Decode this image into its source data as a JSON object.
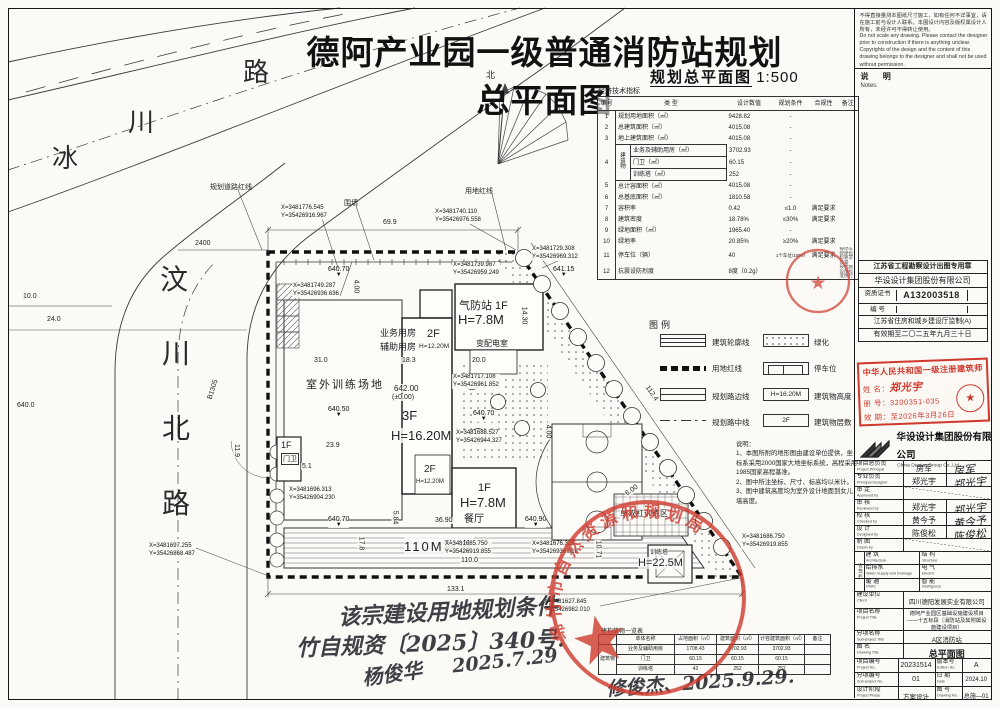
{
  "title": "德阿产业园一级普通消防站规划总平面图",
  "caption": {
    "text": "规划总平面图",
    "scale": "1:500"
  },
  "frame_notes": {
    "disclaimer_zh": "不得直接量测本图纸尺寸施工，如有任何不详事宜，请在施工前与设计人联系。本图设计内容及版权属设计人所有，未经许可不得转让使用。",
    "disclaimer_en": "Do not scale any drawing. Please contact the designer prior to construction if there is anything unclear. Copyrights of the design and the content of this drawing belongs to the designer and shall not be used without permission.",
    "notes_label": "说  明",
    "notes_en": "Notes:"
  },
  "indicators": {
    "title": "经济技术指标",
    "columns": [
      "编号",
      "类  型",
      "设计数值",
      "规划条件",
      "合规性",
      "备注"
    ],
    "group_no": "4",
    "group_label": "建筑物",
    "rows": [
      {
        "no": "1",
        "type": "规划用地面积（㎡）",
        "value": "9428.82",
        "cond": "-",
        "comp": "",
        "note": ""
      },
      {
        "no": "2",
        "type": "总建筑面积（㎡）",
        "value": "4015.08",
        "cond": "-",
        "comp": "",
        "note": ""
      },
      {
        "no": "3",
        "type": "地上建筑面积（㎡）",
        "value": "4015.08",
        "cond": "-",
        "comp": "",
        "note": ""
      },
      {
        "no": "4",
        "type": "业务及辅助用房（㎡）",
        "value": "3702.93",
        "cond": "-",
        "comp": "",
        "note": ""
      },
      {
        "no": "",
        "type": "门卫（㎡）",
        "value": "60.15",
        "cond": "-",
        "comp": "",
        "note": ""
      },
      {
        "no": "",
        "type": "训练塔（㎡）",
        "value": "252",
        "cond": "-",
        "comp": "",
        "note": ""
      },
      {
        "no": "5",
        "type": "总计容面积（㎡）",
        "value": "4015.08",
        "cond": "-",
        "comp": "",
        "note": ""
      },
      {
        "no": "6",
        "type": "总基底面积（㎡）",
        "value": "1810.58",
        "cond": "-",
        "comp": "",
        "note": ""
      },
      {
        "no": "7",
        "type": "容积率",
        "value": "0.42",
        "cond": "≤1.0",
        "comp": "满足要求",
        "note": ""
      },
      {
        "no": "8",
        "type": "建筑密度",
        "value": "18.78%",
        "cond": "≤30%",
        "comp": "满足要求",
        "note": ""
      },
      {
        "no": "9",
        "type": "绿地面积（㎡）",
        "value": "1965.40",
        "cond": "-",
        "comp": "",
        "note": ""
      },
      {
        "no": "10",
        "type": "绿地率",
        "value": "20.85%",
        "cond": "≥20%",
        "comp": "满足要求",
        "note": ""
      },
      {
        "no": "11",
        "type": "停车位（辆）",
        "value": "40",
        "cond": "1个车位/100㎡",
        "comp": "满足要求",
        "note": "按停车配建指标要求设置"
      },
      {
        "no": "12",
        "type": "抗震设防烈度",
        "value": "8度（0.2g）",
        "cond": "",
        "comp": "",
        "note": "按抗震设防标准执行"
      }
    ]
  },
  "legend": {
    "title": "图例",
    "left": [
      {
        "label": "建筑轮廓线"
      },
      {
        "label": "用地红线"
      },
      {
        "label": "规划路边线"
      },
      {
        "label": "规划路中线"
      }
    ],
    "right": [
      {
        "label": "绿化",
        "swatch_text": ""
      },
      {
        "label": "停车位",
        "swatch_text": ""
      },
      {
        "label": "建筑物高度",
        "swatch_text": "H=16.20M"
      },
      {
        "label": "建筑物层数",
        "swatch_text": "2F"
      }
    ]
  },
  "plan_notes": {
    "title": "说明：",
    "lines": [
      "1、本图所附的地形图由建设单位提供，坐标系采用2000国家大地坐标系统，高程采用1985国家高程基准。",
      "2、图中所注坐标、尺寸、标高均以米计。",
      "3、图中建筑高度均为室外设计地面到女儿墙高度。"
    ]
  },
  "roads": {
    "bingchuan": [
      "冰",
      "川",
      "路"
    ],
    "wenchuan": [
      "汶",
      "川",
      "北",
      "路"
    ],
    "north": "北"
  },
  "plan": {
    "leader_labels": {
      "road_red_line": "规划道路红线",
      "fence": "围墙",
      "site_red_line": "用地红线"
    },
    "buildings": {
      "outdoor_field": "室外训练场地",
      "biz_room_1": "业务用房",
      "biz_room_2": "辅助用房",
      "f2a": "2F",
      "f2a_h": "H=12.20M",
      "gas_station": "气防站 1F",
      "gas_station_h": "H=7.8M",
      "transformer": "变配电室",
      "elev_main": "642.00",
      "elev_zero": "(±0.00)",
      "f3": "3F",
      "f3_h": "H=16.20M",
      "f2b": "2F",
      "f2b_h": "H=12.20M",
      "dining_f": "1F",
      "dining_h": "H=7.8M",
      "dining": "餐厅",
      "gate_f": "1F",
      "gate": "门卫",
      "track": "110M跑道",
      "bars_area": "单双杠训练区",
      "tower": "训练塔",
      "tower_h": "H=22.5M"
    },
    "dims": [
      "69.9",
      "2400",
      "10.0",
      "24.0",
      "640.0",
      "B1305",
      "31.0",
      "18.3",
      "20.0",
      "14.30",
      "23.9",
      "11.9",
      "5.1",
      "17.8",
      "36.90",
      "5.84",
      "110.0",
      "133.1",
      "112.4",
      "6.00",
      "4.00",
      "4.00",
      "10.71"
    ],
    "elevations": [
      "641.15",
      "640.70",
      "640.50",
      "640.70",
      "640.70",
      "640.90"
    ],
    "coords": [
      {
        "x": "X=3481776.545",
        "y": "Y=35426916.967"
      },
      {
        "x": "X=3481749.287",
        "y": "Y=35426936.636"
      },
      {
        "x": "X=3481740.110",
        "y": "Y=35426976.558"
      },
      {
        "x": "X=3481729.308",
        "y": "Y=35426969.312"
      },
      {
        "x": "X=3481739.987",
        "y": "Y=35426959.249"
      },
      {
        "x": "X=3481717.108",
        "y": "Y=35426961.852"
      },
      {
        "x": "X=3481688.527",
        "y": "Y=35426944.327"
      },
      {
        "x": "X=3481696.313",
        "y": "Y=35426904.230"
      },
      {
        "x": "X=3481697.255",
        "y": "Y=35426868.487"
      },
      {
        "x": "X=3481685.750",
        "y": "Y=35426919.855"
      },
      {
        "x": "X=3481676.326",
        "y": "Y=35426936.918"
      },
      {
        "x": "X=3481686.750",
        "y": "Y=35426919.855"
      },
      {
        "x": "X=3481627.845",
        "y": "Y=35426982.010"
      }
    ]
  },
  "structures_table": {
    "title": "建构筑物一览表",
    "columns": [
      "单体名称",
      "占地面积（㎡）",
      "建筑面积（㎡）",
      "计容建筑面积（㎡）",
      "备注"
    ],
    "group": "建筑物",
    "rows": [
      {
        "name": "业务及辅助用房",
        "footprint": "1708.43",
        "area": "3702.93",
        "capacity": "3702.93",
        "note": ""
      },
      {
        "name": "门卫",
        "footprint": "60.15",
        "area": "60.15",
        "capacity": "60.15",
        "note": ""
      },
      {
        "name": "训练塔",
        "footprint": "42",
        "area": "252",
        "capacity": "252",
        "note": ""
      }
    ]
  },
  "title_block": {
    "seal_box": {
      "line1": "江苏省工程勘察设计出图专用章",
      "line2": "华设设计集团股份有限公司",
      "cert_label": "资质证书",
      "cert_no": "A132003518",
      "no_label": "编  号",
      "no_value": "",
      "supervise": "江苏省住房和城乡建设厅监制(A)",
      "valid": "有效期至二〇二五年九月三十日"
    },
    "arch_stamp": {
      "title": "中华人民共和国一级注册建筑师",
      "name_label": "姓 名：",
      "name": "郑光宇",
      "reg_label": "册 号：",
      "reg": "3200351-035",
      "valid_label": "效 期：",
      "valid": "至2026年3月26日",
      "seal_star": "★"
    },
    "company": {
      "zh": "华设设计集团股份有限公司",
      "en": "China Design Group Co.,Ltd"
    },
    "personnel": [
      {
        "zh": "项目总负责",
        "en": "Project Principal",
        "name": "房军",
        "sig": "房军"
      },
      {
        "zh": "专业负责",
        "en": "Principal Designer",
        "name": "郑光宇",
        "sig": "郑光宇"
      },
      {
        "zh": "审  定",
        "en": "Approved by",
        "name": "",
        "sig": ""
      },
      {
        "zh": "审  核",
        "en": "Reviewed by",
        "name": "郑光宇",
        "sig": "郑光宇"
      },
      {
        "zh": "校  核",
        "en": "Checked by",
        "name": "黄今予",
        "sig": "黄今予"
      },
      {
        "zh": "设  计",
        "en": "Designed by",
        "name": "陈俊松",
        "sig": "陈俊松"
      },
      {
        "zh": "制  图",
        "en": "Drawn by",
        "name": "",
        "sig": ""
      }
    ],
    "countersign": {
      "label": "会签栏",
      "cells": [
        {
          "zh": "建  筑",
          "en": "Architecture"
        },
        {
          "zh": "结  构",
          "en": "Structure"
        },
        {
          "zh": "给排水",
          "en": "Water Supply and Drainage"
        },
        {
          "zh": "电  气",
          "en": "Electric"
        },
        {
          "zh": "暖  通",
          "en": "HVAC"
        },
        {
          "zh": "智  能",
          "en": "Intelligence"
        }
      ]
    },
    "info": [
      {
        "zh": "建设单位",
        "en": "Client",
        "value": "四川德阳发展实业有限公司"
      },
      {
        "zh": "项目名称",
        "en": "Project Title",
        "value": "德阿产业园区基础设施建设项目——十五标段（消防站及其附属设施建设项目）"
      },
      {
        "zh": "分项名称",
        "en": "Sub-project Title",
        "value": "A区消防站"
      },
      {
        "zh": "图    名",
        "en": "Drawing Title",
        "value": "总平面图"
      }
    ],
    "meta": {
      "proj_no_label": "项目编号",
      "proj_no_en": "Project No.",
      "proj_no": "20231514",
      "edition_label": "版本号",
      "edition_en": "Edition No.",
      "edition": "A",
      "sub_no_label": "分项编号",
      "sub_no_en": "Sub-project No.",
      "sub_no": "01",
      "date_label": "日  期",
      "date_en": "Date",
      "date": "2024.10",
      "phase_label": "设计阶段",
      "phase_en": "Project Phase",
      "phase": "方案设计",
      "dwg_label": "图  号",
      "dwg_en": "Drawing No.",
      "dwg": "总施—01"
    }
  },
  "stamps": {
    "planning_bureau_arc": "绵竹市自然资源和规划局",
    "star": "★"
  },
  "handwriting": {
    "line1": "该宗建设用地规划条件",
    "line2": "竹自规资〔2025〕340号.",
    "sig1": "杨俊华",
    "date1": "2025.7.29",
    "sig2": "修俊杰、2025.9.29."
  }
}
